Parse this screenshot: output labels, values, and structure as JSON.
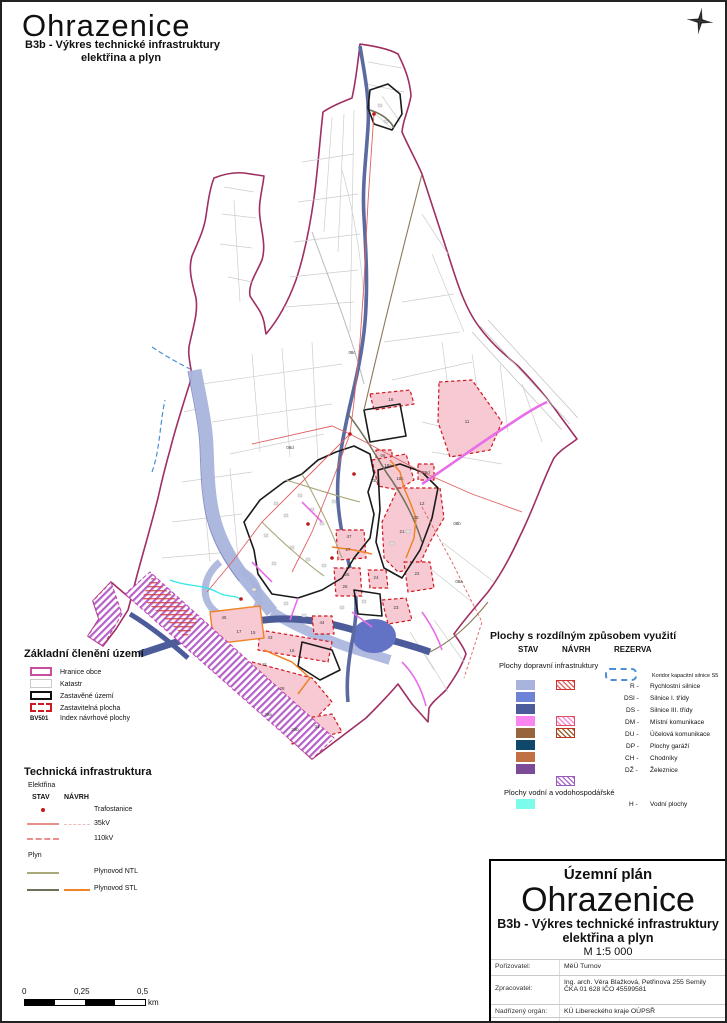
{
  "header": {
    "title": "Ohrazenice",
    "subtitle_line1": "B3b - Výkres technické infrastruktury",
    "subtitle_line2": "elektřina a plyn"
  },
  "legend_basic": {
    "title": "Základní členění území",
    "items": [
      {
        "label": "Hranice obce"
      },
      {
        "label": "Katastr"
      },
      {
        "label": "Zastavěné území"
      },
      {
        "label": "Zastavitelná plocha"
      },
      {
        "index": "BV501",
        "label": "Index návrhové plochy"
      }
    ]
  },
  "legend_tech": {
    "title": "Technická infrastruktura",
    "group1": "Elektřina",
    "col_stav": "STAV",
    "col_navrh": "NÁVRH",
    "row_trafo": "Trafostanice",
    "row_35kv": "35kV",
    "row_110kv": "110kV",
    "group2": "Plyn",
    "row_ntl": "Plynovod NTL",
    "row_stl": "Plynovod STL"
  },
  "legend_areas": {
    "title": "Plochy s rozdílným způsobem využití",
    "col_stav": "STAV",
    "col_navrh": "NÁVRH",
    "col_rezerva": "REZERVA",
    "section_transport": "Plochy dopravní infrastruktury",
    "corridor_label": "Koridor kapacitní silnice S5",
    "rows": [
      {
        "code": "R -",
        "label": "Rychlostní silnice",
        "stav": "#a9b4dc"
      },
      {
        "code": "DSI -",
        "label": "Silnice I. třídy",
        "stav": "#6e82d8"
      },
      {
        "code": "DS -",
        "label": "Silnice III. třídy",
        "stav": "#4c5c9b"
      },
      {
        "code": "DM -",
        "label": "Místní komunikace",
        "stav": "#fb86f0"
      },
      {
        "code": "DU -",
        "label": "Účelová komunikace",
        "stav": "#96653d"
      },
      {
        "code": "DP -",
        "label": "Plochy garáží",
        "stav": "#10486a"
      },
      {
        "code": "CH -",
        "label": "Chodníky",
        "stav": "#bf7144"
      },
      {
        "code": "DŽ -",
        "label": "Železnice",
        "stav": "#7b4b98"
      }
    ],
    "section_water": "Plochy vodní a vodohospodářské",
    "water_row": {
      "code": "H -",
      "label": "Vodní plochy",
      "stav": "#7bfbea"
    }
  },
  "titleblock": {
    "plan_type": "Územní plán",
    "town": "Ohrazenice",
    "subtitle_line1": "B3b - Výkres technické infrastruktury",
    "subtitle_line2": "elektřina a plyn",
    "scale": "M 1:5 000",
    "rows": [
      {
        "label": "Pořizovatel:",
        "value": "MěÚ Turnov",
        "value2": ""
      },
      {
        "label": "Zpracovatel:",
        "value": "Ing. arch. Věra Blažková, Petřinova 255 Semily",
        "value2": "ČKA 01 628 IČO 45599581"
      },
      {
        "label": "Nadřízený orgán:",
        "value": "KÚ Libereckého kraje OÚPSŘ",
        "value2": ""
      },
      {
        "label": "Schvalující orgán:",
        "value": "Zastupitelstvo Ohrazenice",
        "value2": ""
      }
    ]
  },
  "scalebar": {
    "t0": "0",
    "t1": "0,25",
    "t2": "0,5",
    "unit": "km"
  },
  "map": {
    "colors": {
      "boundary": "#9e2f63",
      "cadastre": "#cdcdcd",
      "built_up": "#1a1a1a",
      "zone_fill": "#f7c9d2",
      "zone_border": "#d01820",
      "road_r": "#a9b4dc",
      "road_dsi": "#5b6aa0",
      "road_ds": "#4c5c9b",
      "road_dm": "#e86ee8",
      "el_35kv": "#e06060",
      "trafo": "#c01818",
      "gas_ntl": "#a8a87a",
      "gas_stl": "#70705a",
      "gas_stl_new": "#f08228",
      "water": "#35e8e8",
      "rail_new": "#b050c0"
    },
    "labels": [
      {
        "t": "08c",
        "x": 350,
        "y": 352
      },
      {
        "t": "08d",
        "x": 288,
        "y": 447
      },
      {
        "t": "08b",
        "x": 455,
        "y": 523
      },
      {
        "t": "08a",
        "x": 457,
        "y": 581
      },
      {
        "t": "18",
        "x": 389,
        "y": 399
      },
      {
        "t": "11",
        "x": 465,
        "y": 421
      },
      {
        "t": "06",
        "x": 381,
        "y": 455
      },
      {
        "t": "18a",
        "x": 386,
        "y": 465
      },
      {
        "t": "13b",
        "x": 372,
        "y": 480
      },
      {
        "t": "18c",
        "x": 398,
        "y": 478
      },
      {
        "t": "29d",
        "x": 424,
        "y": 472
      },
      {
        "t": "12",
        "x": 420,
        "y": 503
      },
      {
        "t": "20",
        "x": 414,
        "y": 517
      },
      {
        "t": "21",
        "x": 400,
        "y": 531
      },
      {
        "t": "47",
        "x": 347,
        "y": 536
      },
      {
        "t": "27",
        "x": 346,
        "y": 549
      },
      {
        "t": "25",
        "x": 345,
        "y": 574
      },
      {
        "t": "26",
        "x": 343,
        "y": 586
      },
      {
        "t": "24",
        "x": 374,
        "y": 577
      },
      {
        "t": "22",
        "x": 415,
        "y": 573
      },
      {
        "t": "23",
        "x": 394,
        "y": 607
      },
      {
        "t": "45",
        "x": 222,
        "y": 617
      },
      {
        "t": "17",
        "x": 237,
        "y": 631
      },
      {
        "t": "15",
        "x": 251,
        "y": 632
      },
      {
        "t": "43",
        "x": 268,
        "y": 637
      },
      {
        "t": "16",
        "x": 290,
        "y": 650
      },
      {
        "t": "44",
        "x": 320,
        "y": 622
      },
      {
        "t": "42",
        "x": 262,
        "y": 664
      },
      {
        "t": "28",
        "x": 280,
        "y": 688
      },
      {
        "t": "29a",
        "x": 266,
        "y": 714
      },
      {
        "t": "29b",
        "x": 293,
        "y": 729
      },
      {
        "t": "31",
        "x": 315,
        "y": 726
      }
    ]
  }
}
